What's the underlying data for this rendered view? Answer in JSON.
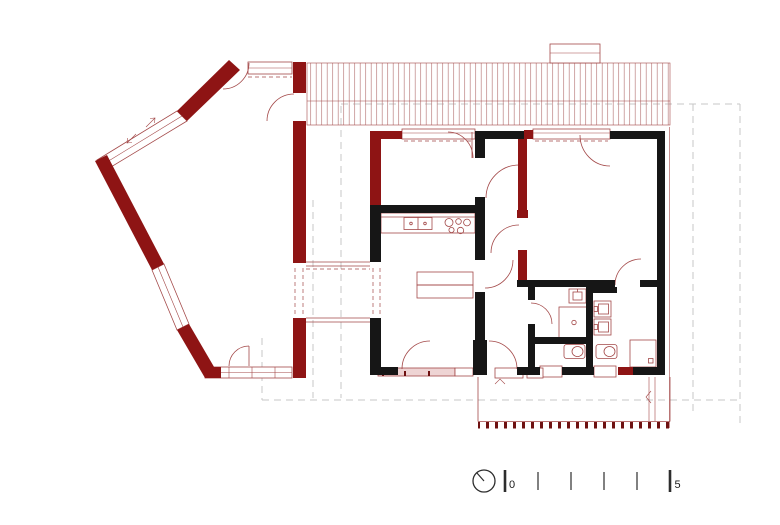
{
  "drawing": {
    "type": "architectural-floor-plan",
    "scale_bar": {
      "start_label": "0",
      "end_label": "5",
      "tick_count": 6,
      "interval_ticks": 4
    },
    "north_indicator": "circle-with-needle"
  },
  "colors": {
    "wall_red": "#8e1414",
    "line_red": "#a34848",
    "hatch_red": "#bb8080",
    "ink": "#161616",
    "dash_gray": "#c7c7c7",
    "pink": "#eed4d4",
    "tick_dark": "#6e1111",
    "bar_ink": "#2d2d2d"
  },
  "elements": {
    "roof_hatch": "battened roof surface",
    "chimney": "roof stack",
    "annex_wing": "angled wing with red masonry walls",
    "link": "connecting passage with openings",
    "main_house": "rectangular house with black walls",
    "fixtures": {
      "kitchen_sink": 1,
      "cooktop_burners": 5,
      "bath_sinks": 3,
      "toilets": 2,
      "showers": 2
    },
    "deck": "south terrace with board ticks"
  }
}
